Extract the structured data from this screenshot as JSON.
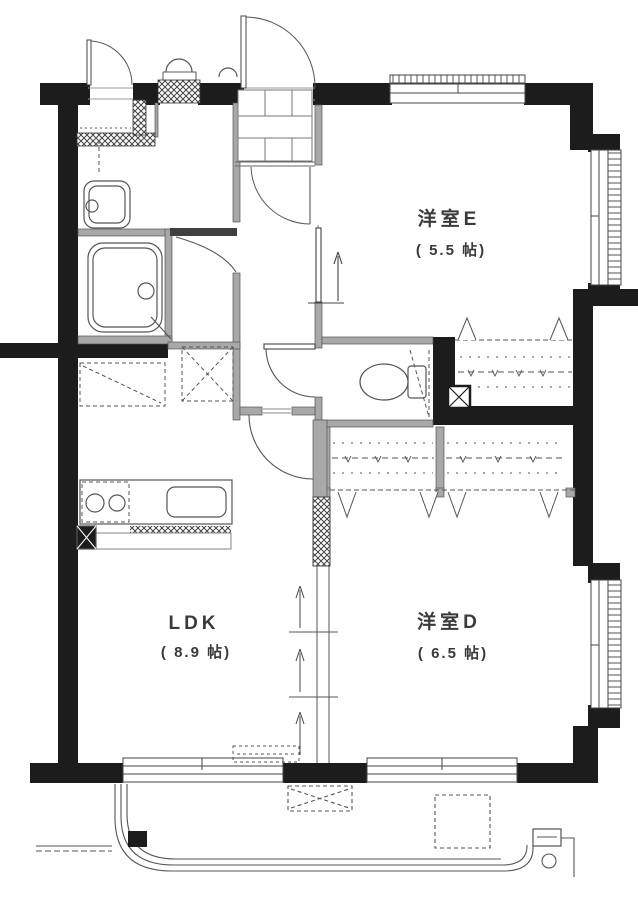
{
  "plan": {
    "title": "apartment-floor-plan",
    "rooms": {
      "room_e": {
        "label": "洋室E",
        "size": "( 5.5 帖)"
      },
      "room_d": {
        "label": "洋室D",
        "size": "( 6.5 帖)"
      },
      "ldk": {
        "label": "LDK",
        "size": "( 8.9 帖)"
      }
    },
    "colors": {
      "wall": "#1c1c1c",
      "interior_wall": "#a8a8a8",
      "line": "#555555",
      "paper": "#ffffff"
    },
    "fixtures": [
      "bathtub",
      "washbasin",
      "toilet",
      "kitchen-counter",
      "kitchen-sink",
      "stove-burners",
      "shoe-tile-grid",
      "entry-door",
      "service-door",
      "meter-box",
      "closet-hanger-pipe",
      "bifold-closet-doors",
      "sliding-partition",
      "balcony-railing",
      "drain-pipe",
      "ac-unit-space",
      "hatch-space"
    ]
  }
}
